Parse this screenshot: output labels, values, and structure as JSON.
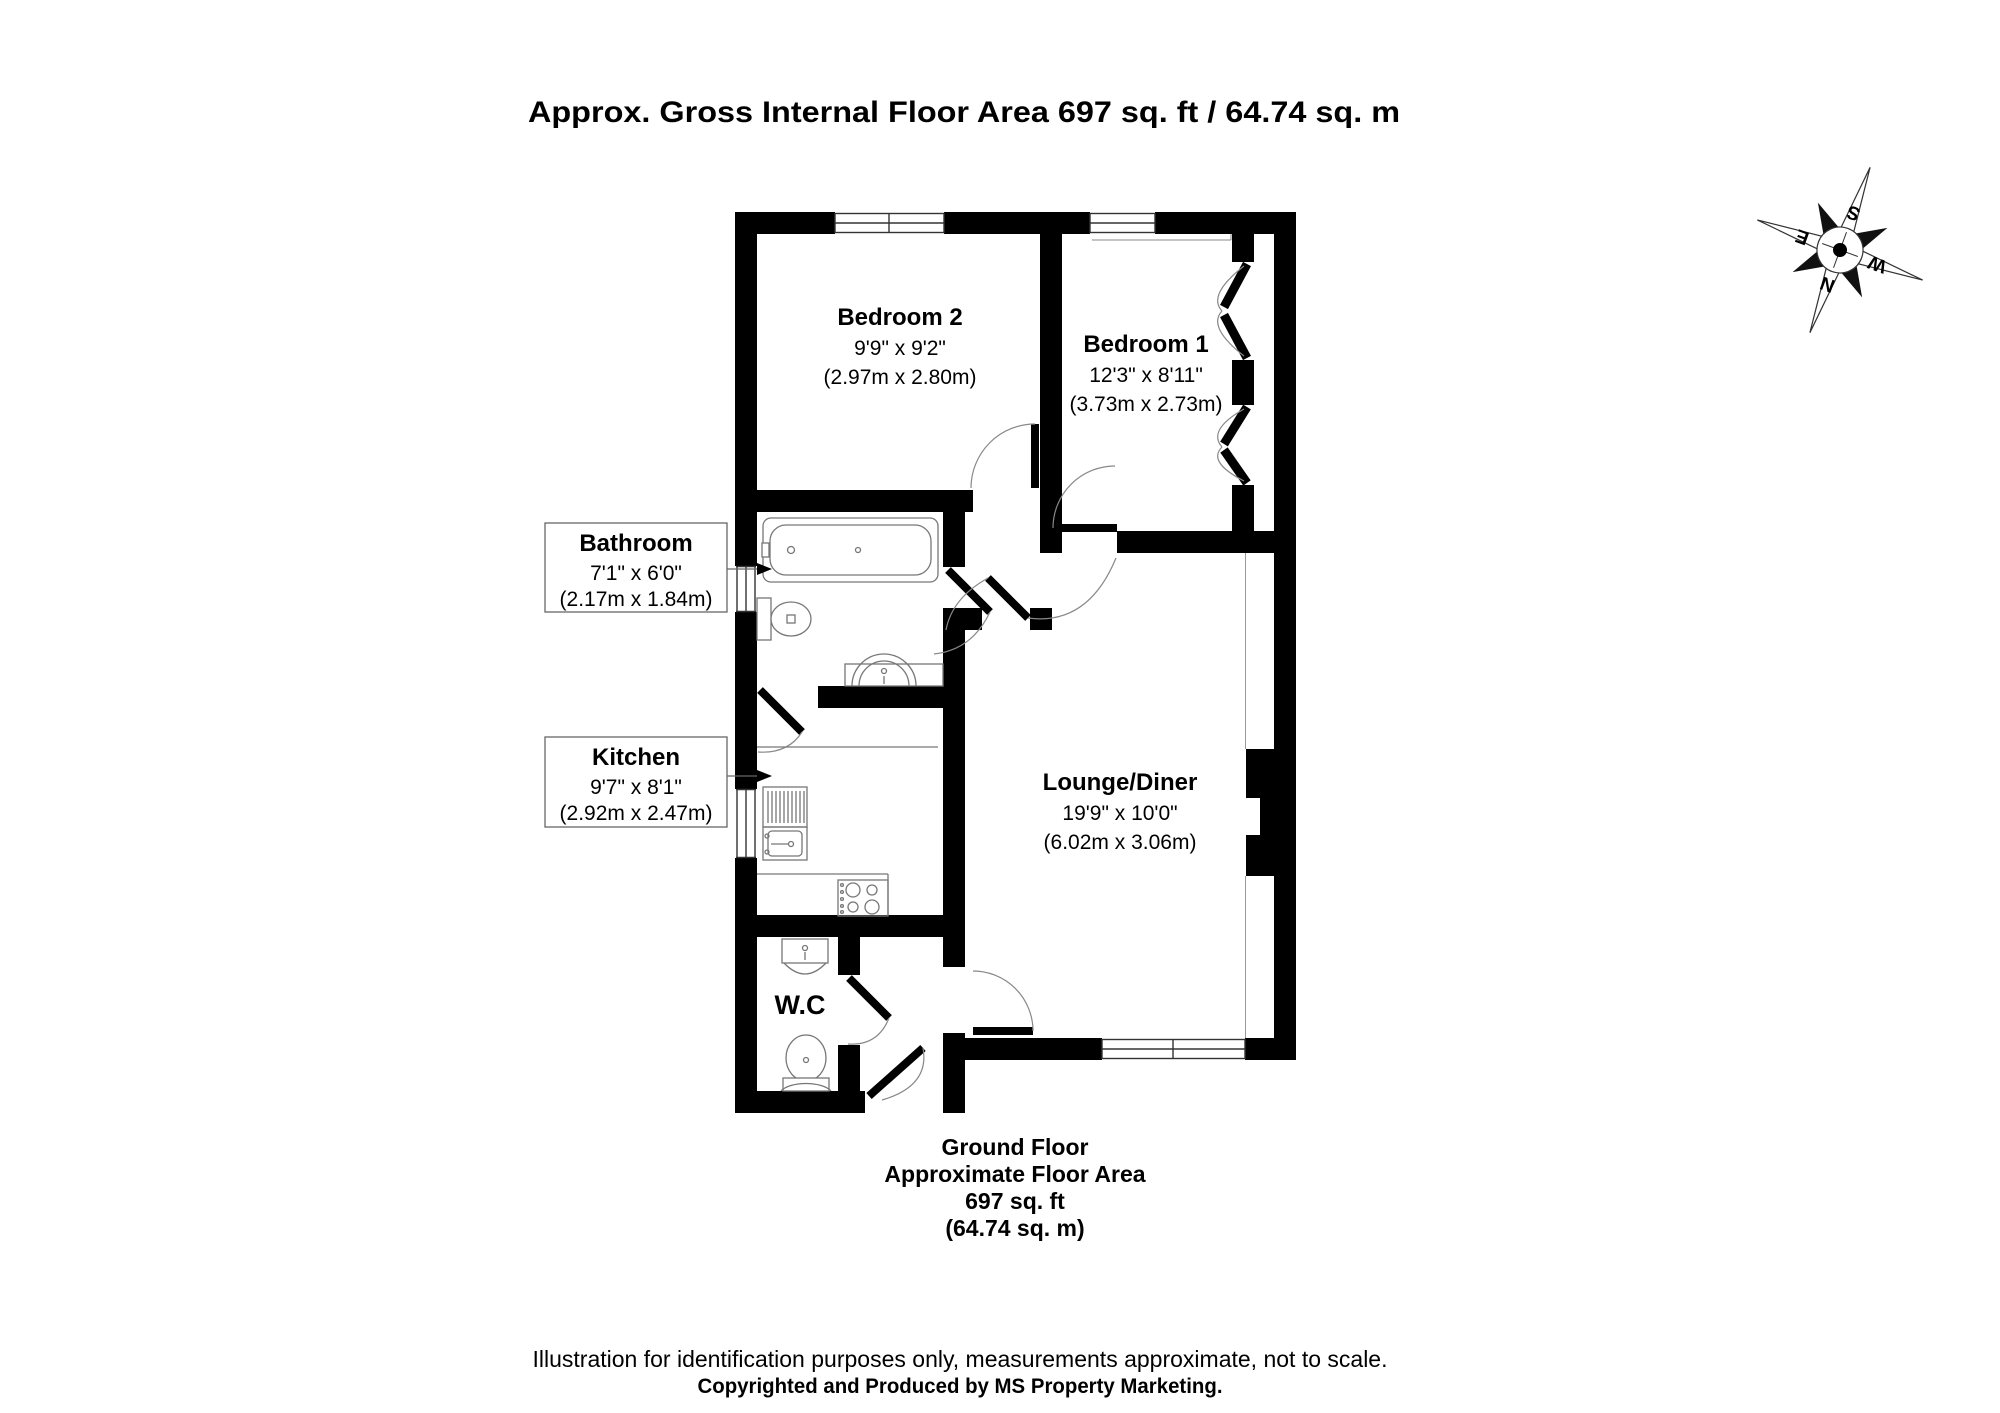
{
  "title": "Approx. Gross Internal Floor Area 697 sq. ft / 64.74 sq. m",
  "rooms": {
    "bedroom2": {
      "name": "Bedroom 2",
      "dims_imperial": "9'9\" x 9'2\"",
      "dims_metric": "(2.97m x 2.80m)"
    },
    "bedroom1": {
      "name": "Bedroom 1",
      "dims_imperial": "12'3\" x 8'11\"",
      "dims_metric": "(3.73m x 2.73m)"
    },
    "bathroom": {
      "name": "Bathroom",
      "dims_imperial": "7'1\" x 6'0\"",
      "dims_metric": "(2.17m x 1.84m)"
    },
    "kitchen": {
      "name": "Kitchen",
      "dims_imperial": "9'7\" x 8'1\"",
      "dims_metric": "(2.92m x 2.47m)"
    },
    "lounge": {
      "name": "Lounge/Diner",
      "dims_imperial": "19'9\" x 10'0\"",
      "dims_metric": "(6.02m x 3.06m)"
    },
    "wc": {
      "name": "W.C"
    }
  },
  "footer": {
    "floor": "Ground Floor",
    "area_label": "Approximate Floor Area",
    "area_ft": "697 sq. ft",
    "area_m": "(64.74 sq. m)"
  },
  "disclaimer": {
    "line1": "Illustration for identification purposes only, measurements approximate, not to scale.",
    "line2": "Copyrighted  and Produced by MS Property Marketing."
  },
  "compass": {
    "n": "N",
    "s": "S",
    "e": "E",
    "w": "W"
  },
  "colors": {
    "wall": "#000000",
    "fixture_line": "#777777",
    "arc_line": "#888888",
    "background": "#ffffff"
  }
}
